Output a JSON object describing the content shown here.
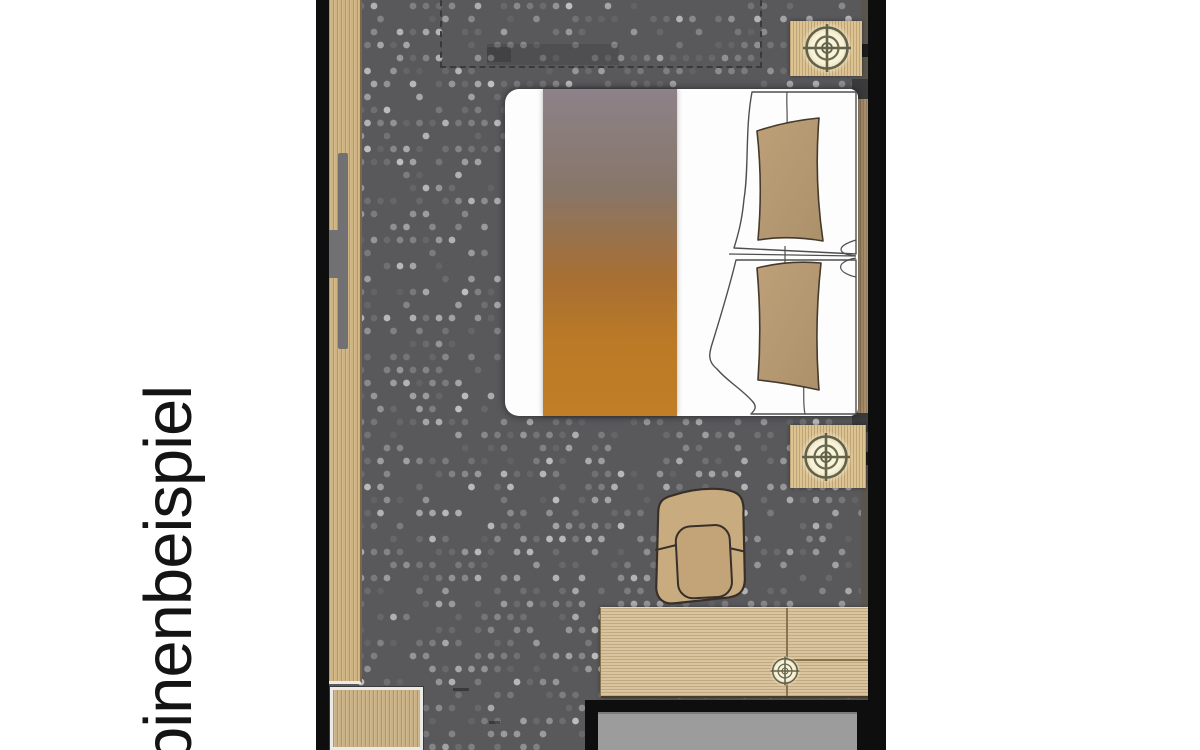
{
  "label": {
    "text": "binenbeispiel"
  },
  "palette": {
    "wall": "#0e0e0e",
    "carpet_base": "#59595c",
    "wood": "#cfb381",
    "wood_edge": "#7e6744",
    "desk_wood": "#d8c49e",
    "nightstand_wood": "#dcc394",
    "box_wood": "#c9b183",
    "headboard": "#a8906f",
    "pillow": "#b69b72",
    "runner_top": "#8d8289",
    "runner_bottom": "#c17e27",
    "lamp_glow": "#f7f2d8",
    "lamp_ring": "#62624a",
    "bathroom_floor": "#9c9c9c",
    "handle": "#717174",
    "chair": "#c9ab80",
    "text": "#141414"
  },
  "carpet_pattern": {
    "dot_spacing": 13,
    "dot_radius": 3.4,
    "seed": 12,
    "blank_ratio": 0.4,
    "max_opacity": 0.55
  },
  "floorplan_items": [
    "left-wall",
    "wardrobe-with-handle",
    "carpet",
    "overhead-berth-dashed-outline",
    "double-bed",
    "bed-runner",
    "pillows",
    "bedside-table-top",
    "bedside-lamp-top",
    "bedside-table-middle",
    "bedside-lamp-middle",
    "armchair",
    "sideboard-desk",
    "reading-lamp",
    "bathroom",
    "shower-unit",
    "right-wall"
  ]
}
